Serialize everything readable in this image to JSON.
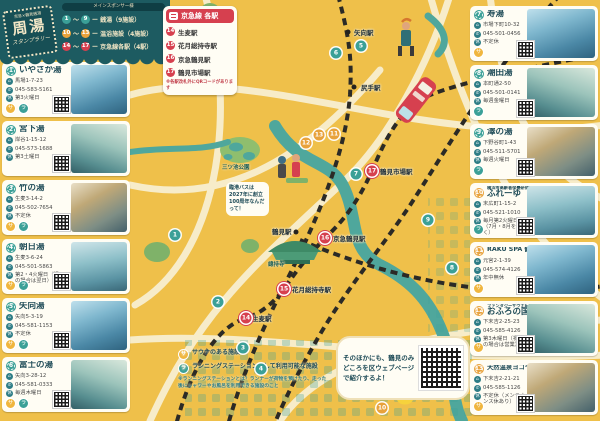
{
  "banner": {
    "sponsor_note": "メインスポンサー様",
    "logo": {
      "top": "京急×鶴見銭湯",
      "main": "周湯",
      "sub": "スタンプラリー"
    },
    "legend": [
      {
        "from": "1",
        "to": "9",
        "label": "銭湯（9施設）",
        "type": "sento"
      },
      {
        "from": "10",
        "to": "13",
        "label": "温浴施設（4施設）",
        "type": "onyoku"
      },
      {
        "from": "14",
        "to": "17",
        "label": "京急線各駅（4駅）",
        "type": "station"
      }
    ]
  },
  "station_box": {
    "title": "京急線 各駅",
    "stations": [
      {
        "num": "14",
        "name": "生麦駅"
      },
      {
        "num": "15",
        "name": "花月総持寺駅"
      },
      {
        "num": "16",
        "name": "京急鶴見駅"
      },
      {
        "num": "17",
        "name": "鶴見市場駅"
      }
    ],
    "note": "※各駅改札外にQRコードがあります"
  },
  "facilities_left": [
    {
      "num": "1",
      "type": "sento",
      "name": "いやさか湯",
      "address": "馬場1-7-23",
      "phone": "045-583-5161",
      "closed": "第3火曜日",
      "badges": [
        "サ",
        "ラ"
      ]
    },
    {
      "num": "2",
      "type": "sento",
      "name": "宮下湯",
      "address": "岸谷1-15-12",
      "phone": "045-573-1688",
      "closed": "第3土曜日",
      "badges": []
    },
    {
      "num": "3",
      "type": "sento",
      "name": "竹の湯",
      "address": "生麦3-14-2",
      "phone": "045-502-7654",
      "closed": "不定休",
      "badges": [
        "サ",
        "ラ"
      ]
    },
    {
      "num": "4",
      "type": "sento",
      "name": "朝日湯",
      "address": "生麦3-6-24",
      "phone": "045-501-5863",
      "closed": "第2・4火曜日（祝日の場合は翌日）",
      "badges": [
        "サ",
        "ラ"
      ]
    },
    {
      "num": "5",
      "type": "sento",
      "name": "矢向湯",
      "address": "矢向5-3-19",
      "phone": "045-581-1153",
      "closed": "不定休",
      "badges": [
        "サ",
        "ラ"
      ]
    },
    {
      "num": "6",
      "type": "sento",
      "name": "富士の湯",
      "address": "矢向3-28-12",
      "phone": "045-581-0333",
      "closed": "毎週木曜日",
      "badges": [
        "サ",
        "ラ"
      ]
    }
  ],
  "facilities_right": [
    {
      "num": "7",
      "type": "sento",
      "name": "寿湯",
      "address": "市場下町10-32",
      "phone": "045-501-0456",
      "closed": "不定休",
      "badges": [
        "サ"
      ]
    },
    {
      "num": "8",
      "type": "sento",
      "name": "潮田湯",
      "address": "本町通2-50",
      "phone": "045-501-0141",
      "closed": "毎週金曜日",
      "badges": [
        "ラ"
      ]
    },
    {
      "num": "9",
      "type": "sento",
      "name": "澤の湯",
      "address": "下野谷町1-43",
      "phone": "045-511-5701",
      "closed": "毎週火曜日",
      "badges": [
        "ラ"
      ]
    },
    {
      "num": "10",
      "type": "onyoku",
      "prefix": "横浜市高齢者保養研修施設",
      "name": "ふれーゆ",
      "address": "末広町1-15-2",
      "phone": "045-521-1010",
      "closed": "毎月第2火曜日（7月・8月を除く）",
      "badges": [
        "ラ"
      ]
    },
    {
      "num": "11",
      "type": "onyoku",
      "name": "RAKU SPA 鶴見",
      "address": "元宮2-1-39",
      "phone": "045-574-4126",
      "closed": "年中無休",
      "badges": [
        "サ"
      ]
    },
    {
      "num": "12",
      "type": "onyoku",
      "prefix": "ファンタジーサウナ&スパ",
      "name": "おふろの国",
      "address": "下末吉2-25-23",
      "phone": "045-585-4126",
      "closed": "第3木曜日（祝日の場合は営業）",
      "badges": [
        "サ"
      ]
    },
    {
      "num": "13",
      "type": "onyoku",
      "name": "天然温泉ヨコヤマ・ユーランド鶴見",
      "address": "下末吉2-21-21",
      "phone": "045-585-1126",
      "closed": "不定休（メンテナンス休あり）",
      "badges": [
        "サ"
      ]
    }
  ],
  "map": {
    "stations": [
      {
        "name": "矢向駅",
        "x": 348,
        "y": 32,
        "lx": 354,
        "ly": 27
      },
      {
        "name": "尻手駅",
        "x": 354,
        "y": 87,
        "lx": 361,
        "ly": 82
      },
      {
        "name": "鶴見市場駅",
        "x": 372,
        "y": 171,
        "lx": 380,
        "ly": 166
      },
      {
        "name": "鶴見駅",
        "x": 296,
        "y": 232,
        "lx": 272,
        "ly": 226
      },
      {
        "name": "京急鶴見駅",
        "x": 325,
        "y": 238,
        "lx": 333,
        "ly": 233
      },
      {
        "name": "花月総持寺駅",
        "x": 284,
        "y": 289,
        "lx": 292,
        "ly": 284
      },
      {
        "name": "生麦駅",
        "x": 246,
        "y": 318,
        "lx": 252,
        "ly": 313
      }
    ],
    "markers": [
      {
        "num": "1",
        "type": "sento",
        "x": 175,
        "y": 235
      },
      {
        "num": "2",
        "type": "sento",
        "x": 218,
        "y": 302
      },
      {
        "num": "3",
        "type": "sento",
        "x": 243,
        "y": 348
      },
      {
        "num": "4",
        "type": "sento",
        "x": 261,
        "y": 369
      },
      {
        "num": "5",
        "type": "sento",
        "x": 361,
        "y": 46
      },
      {
        "num": "6",
        "type": "sento",
        "x": 336,
        "y": 53
      },
      {
        "num": "7",
        "type": "sento",
        "x": 356,
        "y": 174
      },
      {
        "num": "8",
        "type": "sento",
        "x": 452,
        "y": 268
      },
      {
        "num": "9",
        "type": "sento",
        "x": 428,
        "y": 220
      },
      {
        "num": "10",
        "type": "onyoku",
        "x": 382,
        "y": 408
      },
      {
        "num": "11",
        "type": "onyoku",
        "x": 334,
        "y": 134
      },
      {
        "num": "12",
        "type": "onyoku",
        "x": 306,
        "y": 143
      },
      {
        "num": "13",
        "type": "onyoku",
        "x": 319,
        "y": 135
      },
      {
        "num": "14",
        "type": "station",
        "x": 246,
        "y": 318
      },
      {
        "num": "15",
        "type": "station",
        "x": 284,
        "y": 289
      },
      {
        "num": "16",
        "type": "station",
        "x": 325,
        "y": 238
      },
      {
        "num": "17",
        "type": "station",
        "x": 372,
        "y": 171
      }
    ],
    "labels": [
      {
        "text": "總持寺",
        "x": 268,
        "y": 260
      },
      {
        "text": "三ツ池公園",
        "x": 222,
        "y": 163
      }
    ],
    "bubble_left": "臨港バスは2027年に創立100周年なんだって！",
    "bubble_main": "そのほかにも、鶴見のみどころを区ウェブページで紹介するよ！"
  },
  "map_legend": {
    "sauna": {
      "badge": "サ",
      "label": "サウナのある施設"
    },
    "run": {
      "badge": "ラ",
      "label": "ランニングステーションとして利用可能な施設"
    },
    "note": "※ランニングステーションとは？ランナーが荷物を預けたり、走った後にシャワーやお風呂を利用できる施設のこと"
  },
  "colors": {
    "background": "#EFC04A",
    "banner": "#1D5B61",
    "sento": "#3BA097",
    "onyoku": "#E8A23B",
    "keikyu_red": "#D6404F",
    "road": "#F7ECC9",
    "river": "#4FA79C"
  }
}
